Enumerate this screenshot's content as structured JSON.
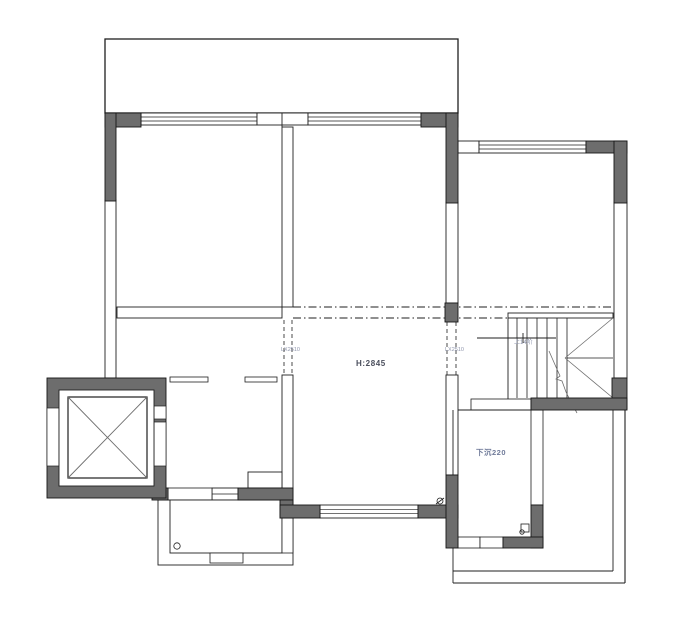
{
  "title": "residential-floor-plan",
  "canvas": {
    "width": 692,
    "height": 620,
    "background": "#ffffff"
  },
  "colors": {
    "line": "#1f1f1f",
    "wall_fill": "#6d6d6d",
    "wall_stroke": "#161616",
    "diag": "#6e6e6e",
    "label_primary": "#4a4e5c",
    "label_secondary": "#8e94ab",
    "label_sunken": "#6f7a99"
  },
  "labels": {
    "height": "H:2845",
    "sunken": "下沉220",
    "beam_left": "LX2510",
    "beam_right": "LX2510",
    "stair_note": "上14阶"
  },
  "geometry": {
    "shapes": [
      {
        "t": "rect",
        "n": "terrace-top",
        "x": 105,
        "y": 39,
        "w": 353,
        "h": 74,
        "f": "white",
        "sw": 1.3
      },
      {
        "t": "hwin",
        "n": "window-top-left",
        "x": 141,
        "y": 113,
        "w": 116,
        "h": 12,
        "inner": 2
      },
      {
        "t": "rect",
        "n": "wall-band",
        "x": 257,
        "y": 113,
        "w": 51,
        "h": 12,
        "f": "white",
        "sw": 0.9
      },
      {
        "t": "hwin",
        "n": "window-top-center",
        "x": 308,
        "y": 113,
        "w": 113,
        "h": 12,
        "inner": 2
      },
      {
        "t": "line",
        "n": "wall-line",
        "x1": 282,
        "y1": 113,
        "x2": 282,
        "y2": 127,
        "sw": 0.9
      },
      {
        "t": "rect",
        "n": "wall-band",
        "x": 458,
        "y": 141,
        "w": 21,
        "h": 12,
        "f": "white",
        "sw": 0.9
      },
      {
        "t": "hwin",
        "n": "window-top-right",
        "x": 479,
        "y": 141,
        "w": 107,
        "h": 12,
        "inner": 2
      },
      {
        "t": "rect",
        "n": "window-left-wall",
        "x": 105,
        "y": 200,
        "w": 11,
        "h": 178,
        "f": "white",
        "sw": 0.9
      },
      {
        "t": "rect",
        "n": "wall-band",
        "x": 446,
        "y": 202,
        "w": 12,
        "h": 101,
        "f": "white",
        "sw": 0.9
      },
      {
        "t": "rect",
        "n": "window-right-wall",
        "x": 614,
        "y": 202,
        "w": 13,
        "h": 176,
        "f": "white",
        "sw": 0.9
      },
      {
        "t": "rect",
        "n": "wall-divider-upper",
        "x": 282,
        "y": 127,
        "w": 11,
        "h": 180,
        "f": "white",
        "sw": 0.9
      },
      {
        "t": "rect",
        "n": "wall-divider-lower",
        "x": 282,
        "y": 375,
        "w": 11,
        "h": 125,
        "f": "white",
        "sw": 0.9
      },
      {
        "t": "rect",
        "n": "wall-band",
        "x": 446,
        "y": 375,
        "w": 12,
        "h": 100,
        "f": "white",
        "sw": 0.9
      },
      {
        "t": "rect",
        "n": "wall-left-room-bottom",
        "x": 117,
        "y": 307,
        "w": 165,
        "h": 11,
        "f": "white",
        "sw": 0.9
      },
      {
        "t": "line",
        "n": "beam-line",
        "x1": 293,
        "y1": 307,
        "x2": 613,
        "y2": 307,
        "sw": 0.9,
        "dash": "dashdot"
      },
      {
        "t": "line",
        "n": "beam-line",
        "x1": 293,
        "y1": 318,
        "x2": 508,
        "y2": 318,
        "sw": 0.9,
        "dash": "dashdot"
      },
      {
        "t": "line",
        "n": "beam-edge",
        "x1": 284,
        "y1": 320,
        "x2": 284,
        "y2": 375,
        "sw": 0.8,
        "dash": "dash"
      },
      {
        "t": "line",
        "n": "beam-edge",
        "x1": 292,
        "y1": 320,
        "x2": 292,
        "y2": 375,
        "sw": 0.8,
        "dash": "dash"
      },
      {
        "t": "line",
        "n": "beam-edge",
        "x1": 447,
        "y1": 322,
        "x2": 447,
        "y2": 375,
        "sw": 0.8,
        "dash": "dash"
      },
      {
        "t": "line",
        "n": "beam-edge",
        "x1": 456,
        "y1": 322,
        "x2": 456,
        "y2": 375,
        "sw": 0.8,
        "dash": "dash"
      },
      {
        "t": "rect",
        "n": "stair-top-band",
        "x": 508,
        "y": 313,
        "w": 105,
        "h": 5,
        "f": "white",
        "sw": 0.9
      },
      {
        "t": "line",
        "n": "stair-side-wall",
        "x1": 508,
        "y1": 318,
        "x2": 508,
        "y2": 402,
        "sw": 0.9
      },
      {
        "t": "line",
        "n": "stair-tread",
        "x1": 517,
        "y1": 318,
        "x2": 517,
        "y2": 398,
        "sw": 0.8
      },
      {
        "t": "line",
        "n": "stair-tread",
        "x1": 527,
        "y1": 318,
        "x2": 527,
        "y2": 398,
        "sw": 0.8
      },
      {
        "t": "line",
        "n": "stair-tread",
        "x1": 537,
        "y1": 318,
        "x2": 537,
        "y2": 398,
        "sw": 0.8
      },
      {
        "t": "line",
        "n": "stair-tread",
        "x1": 547,
        "y1": 318,
        "x2": 547,
        "y2": 398,
        "sw": 0.8
      },
      {
        "t": "line",
        "n": "stair-tread",
        "x1": 557,
        "y1": 318,
        "x2": 557,
        "y2": 398,
        "sw": 0.8
      },
      {
        "t": "line",
        "n": "stair-tread",
        "x1": 567,
        "y1": 318,
        "x2": 567,
        "y2": 398,
        "sw": 0.8
      },
      {
        "t": "line",
        "n": "stair-mid-line",
        "x1": 567,
        "y1": 358,
        "x2": 613,
        "y2": 358,
        "sw": 0.8
      },
      {
        "t": "line",
        "n": "stair-winder",
        "x1": 565,
        "y1": 358,
        "x2": 613,
        "y2": 318,
        "sw": 0.8,
        "col": "diag"
      },
      {
        "t": "line",
        "n": "stair-winder",
        "x1": 565,
        "y1": 358,
        "x2": 613,
        "y2": 398,
        "sw": 0.8,
        "col": "diag"
      },
      {
        "t": "line",
        "n": "stair-up-line",
        "x1": 477,
        "y1": 338,
        "x2": 556,
        "y2": 338,
        "sw": 0.9
      },
      {
        "t": "line",
        "n": "stair-up-tick",
        "x1": 523,
        "y1": 333,
        "x2": 523,
        "y2": 343,
        "sw": 0.9
      },
      {
        "t": "poly",
        "n": "stair-break-line",
        "pts": [
          [
            549,
            351
          ],
          [
            556,
            367
          ],
          [
            560,
            376
          ],
          [
            556,
            379
          ],
          [
            562,
            381
          ],
          [
            566,
            392
          ],
          [
            572,
            404
          ],
          [
            577,
            413
          ]
        ],
        "sw": 0.8,
        "col": "diag"
      },
      {
        "t": "rect",
        "n": "door-sill",
        "x": 170,
        "y": 377,
        "w": 38,
        "h": 5,
        "f": "white",
        "sw": 0.8
      },
      {
        "t": "rect",
        "n": "door-sill",
        "x": 245,
        "y": 377,
        "w": 32,
        "h": 5,
        "f": "white",
        "sw": 0.8
      },
      {
        "t": "rect",
        "n": "niche",
        "x": 248,
        "y": 472,
        "w": 34,
        "h": 16,
        "f": "white",
        "sw": 0.9
      },
      {
        "t": "rect",
        "n": "stair-landing-step",
        "x": 471,
        "y": 399,
        "w": 60,
        "h": 11,
        "f": "white",
        "sw": 0.8
      },
      {
        "t": "hwin",
        "n": "window-bottom-center",
        "x": 320,
        "y": 505,
        "w": 98,
        "h": 13,
        "inner": 2
      },
      {
        "t": "hwin",
        "n": "window-bathroom",
        "x": 212,
        "y": 488,
        "w": 26,
        "h": 12,
        "inner": 1
      },
      {
        "t": "rect",
        "n": "wall-band",
        "x": 168,
        "y": 488,
        "w": 44,
        "h": 12,
        "f": "white",
        "sw": 0.8
      },
      {
        "t": "rect",
        "n": "bathroom-outer",
        "x": 158,
        "y": 500,
        "w": 135,
        "h": 65,
        "f": "none",
        "sw": 0.9
      },
      {
        "t": "rect",
        "n": "bathroom-room",
        "x": 170,
        "y": 500,
        "w": 112,
        "h": 53,
        "f": "white",
        "sw": 0.9
      },
      {
        "t": "rect",
        "n": "bathroom-step",
        "x": 210,
        "y": 553,
        "w": 33,
        "h": 10,
        "f": "white",
        "sw": 0.8
      },
      {
        "t": "rect",
        "n": "wall-band",
        "x": 282,
        "y": 518,
        "w": 11,
        "h": 35,
        "f": "white",
        "sw": 0.8
      },
      {
        "t": "line",
        "n": "sunken-room-top",
        "x1": 458,
        "y1": 410,
        "x2": 531,
        "y2": 410,
        "sw": 0.9
      },
      {
        "t": "rect",
        "n": "wall-band",
        "x": 531,
        "y": 410,
        "w": 12,
        "h": 95,
        "f": "white",
        "sw": 0.8
      },
      {
        "t": "rect",
        "n": "door-cell",
        "x": 458,
        "y": 537,
        "w": 22,
        "h": 11,
        "f": "white",
        "sw": 0.8
      },
      {
        "t": "rect",
        "n": "door-cell",
        "x": 480,
        "y": 537,
        "w": 23,
        "h": 11,
        "f": "white",
        "sw": 0.8
      },
      {
        "t": "line",
        "n": "terrace-line",
        "x1": 613,
        "y1": 410,
        "x2": 613,
        "y2": 571,
        "sw": 0.9
      },
      {
        "t": "line",
        "n": "terrace-line",
        "x1": 625,
        "y1": 408,
        "x2": 625,
        "y2": 583,
        "sw": 1.1
      },
      {
        "t": "line",
        "n": "terrace-line",
        "x1": 453,
        "y1": 571,
        "x2": 613,
        "y2": 571,
        "sw": 0.9
      },
      {
        "t": "line",
        "n": "terrace-line",
        "x1": 453,
        "y1": 583,
        "x2": 625,
        "y2": 583,
        "sw": 1.1
      },
      {
        "t": "line",
        "n": "terrace-line",
        "x1": 453,
        "y1": 410,
        "x2": 453,
        "y2": 583,
        "sw": 0.9
      },
      {
        "t": "rect",
        "n": "wall-dark",
        "x": 105,
        "y": 113,
        "w": 36,
        "h": 14,
        "f": "dark"
      },
      {
        "t": "rect",
        "n": "wall-dark",
        "x": 105,
        "y": 113,
        "w": 11,
        "h": 88,
        "f": "dark"
      },
      {
        "t": "rect",
        "n": "wall-dark",
        "x": 421,
        "y": 113,
        "w": 37,
        "h": 14,
        "f": "dark"
      },
      {
        "t": "rect",
        "n": "wall-dark",
        "x": 446,
        "y": 113,
        "w": 12,
        "h": 90,
        "f": "dark"
      },
      {
        "t": "rect",
        "n": "wall-dark",
        "x": 586,
        "y": 141,
        "w": 41,
        "h": 12,
        "f": "dark"
      },
      {
        "t": "rect",
        "n": "wall-dark",
        "x": 614,
        "y": 141,
        "w": 13,
        "h": 62,
        "f": "dark"
      },
      {
        "t": "rect",
        "n": "wall-column",
        "x": 445,
        "y": 303,
        "w": 13,
        "h": 19,
        "f": "dark"
      },
      {
        "t": "rect",
        "n": "wall-dark",
        "x": 612,
        "y": 378,
        "w": 15,
        "h": 31,
        "f": "dark"
      },
      {
        "t": "rect",
        "n": "wall-dark",
        "x": 531,
        "y": 398,
        "w": 96,
        "h": 12,
        "f": "dark"
      },
      {
        "t": "rect",
        "n": "wall-dark",
        "x": 238,
        "y": 488,
        "w": 55,
        "h": 12,
        "f": "dark"
      },
      {
        "t": "rect",
        "n": "wall-dark",
        "x": 152,
        "y": 488,
        "w": 16,
        "h": 12,
        "f": "dark"
      },
      {
        "t": "rect",
        "n": "wall-dark",
        "x": 280,
        "y": 500,
        "w": 13,
        "h": 18,
        "f": "dark"
      },
      {
        "t": "rect",
        "n": "wall-dark",
        "x": 280,
        "y": 505,
        "w": 40,
        "h": 13,
        "f": "dark"
      },
      {
        "t": "rect",
        "n": "wall-dark",
        "x": 418,
        "y": 505,
        "w": 40,
        "h": 13,
        "f": "dark"
      },
      {
        "t": "rect",
        "n": "wall-dark",
        "x": 446,
        "y": 475,
        "w": 12,
        "h": 73,
        "f": "dark"
      },
      {
        "t": "rect",
        "n": "wall-dark",
        "x": 531,
        "y": 505,
        "w": 12,
        "h": 43,
        "f": "dark"
      },
      {
        "t": "rect",
        "n": "wall-dark",
        "x": 503,
        "y": 537,
        "w": 40,
        "h": 11,
        "f": "dark"
      },
      {
        "t": "rect",
        "n": "elevator-shaft",
        "x": 47,
        "y": 378,
        "w": 119,
        "h": 120,
        "f": "dark",
        "sw": 0.9
      },
      {
        "t": "rect",
        "n": "elevator-door-gap",
        "x": 47,
        "y": 408,
        "w": 12,
        "h": 58,
        "f": "white",
        "sw": 0.7
      },
      {
        "t": "rect",
        "n": "elevator-door-gap",
        "x": 154,
        "y": 406,
        "w": 12,
        "h": 13,
        "f": "white",
        "sw": 0.7
      },
      {
        "t": "rect",
        "n": "elevator-door-gap",
        "x": 154,
        "y": 422,
        "w": 12,
        "h": 44,
        "f": "white",
        "sw": 0.7
      },
      {
        "t": "rect",
        "n": "elevator-inner",
        "x": 59,
        "y": 390,
        "w": 95,
        "h": 96,
        "f": "white",
        "sw": 0.9
      },
      {
        "t": "rect",
        "n": "elevator-cab",
        "x": 68,
        "y": 397,
        "w": 79,
        "h": 81,
        "f": "white",
        "sw": 1.2
      },
      {
        "t": "line",
        "n": "elevator-cross",
        "x1": 68,
        "y1": 397,
        "x2": 147,
        "y2": 478,
        "sw": 0.9,
        "col": "diag"
      },
      {
        "t": "line",
        "n": "elevator-cross",
        "x1": 147,
        "y1": 397,
        "x2": 68,
        "y2": 478,
        "sw": 0.9,
        "col": "diag"
      },
      {
        "t": "circle",
        "n": "floor-drain",
        "cx": 177,
        "cy": 546,
        "r": 3.2
      },
      {
        "t": "circle",
        "n": "floor-drain",
        "cx": 440,
        "cy": 501,
        "r": 3
      },
      {
        "t": "line",
        "n": "drain-slash",
        "x1": 436,
        "y1": 504,
        "x2": 444,
        "y2": 498,
        "sw": 0.8
      },
      {
        "t": "rect",
        "n": "door-symbol",
        "x": 521,
        "y": 524,
        "w": 8,
        "h": 8,
        "f": "white",
        "sw": 0.8
      },
      {
        "t": "circle",
        "n": "door-symbol-circle",
        "cx": 522,
        "cy": 532,
        "r": 2.2
      },
      {
        "t": "text",
        "n": "label-ceiling-height",
        "bind": "labels.height",
        "x": 356,
        "y": 366,
        "size": 8,
        "col": "label_primary",
        "bold": true,
        "ls": 0.6
      },
      {
        "t": "text",
        "n": "label-beam-left",
        "bind": "labels.beam_left",
        "x": 281,
        "y": 351,
        "size": 5.5,
        "col": "label_secondary"
      },
      {
        "t": "text",
        "n": "label-beam-right",
        "bind": "labels.beam_right",
        "x": 445,
        "y": 351,
        "size": 5.5,
        "col": "label_secondary"
      },
      {
        "t": "text",
        "n": "label-stair-note",
        "bind": "labels.stair_note",
        "x": 514,
        "y": 344,
        "size": 6,
        "col": "label_secondary"
      },
      {
        "t": "text",
        "n": "label-sunken",
        "bind": "labels.sunken",
        "x": 476,
        "y": 455,
        "size": 7.5,
        "col": "label_sunken",
        "bold": true,
        "ls": 0.5
      }
    ]
  }
}
